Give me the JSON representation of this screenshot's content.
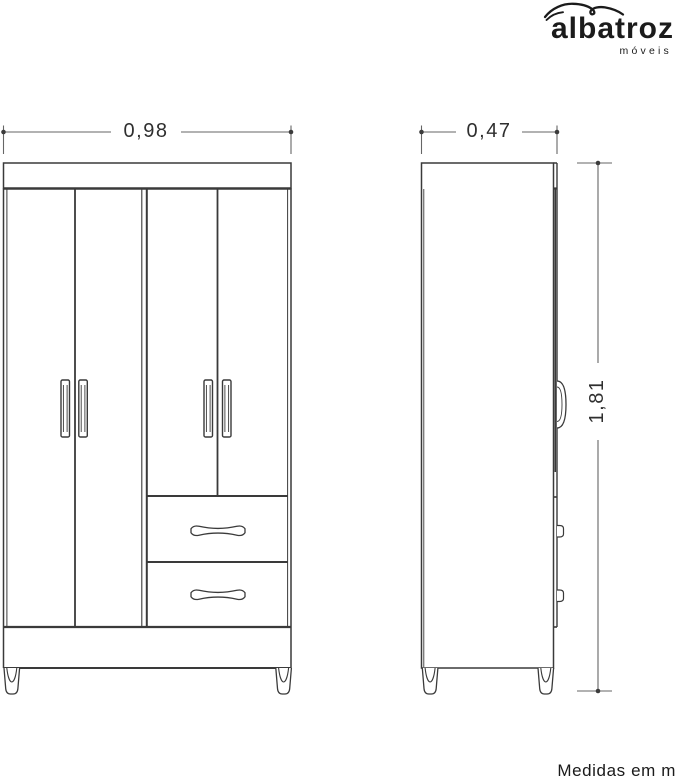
{
  "logo": {
    "brand": "albatroz",
    "subtitle": "móveis"
  },
  "dimensions": {
    "front_width_m": "0,98",
    "side_depth_m": "0,47",
    "height_m": "1,81"
  },
  "footer": {
    "note": "Medidas em m"
  },
  "colors": {
    "line": "#3a3a3a",
    "dimension_line": "#666666",
    "text": "#2f2f2f",
    "background": "#ffffff"
  }
}
